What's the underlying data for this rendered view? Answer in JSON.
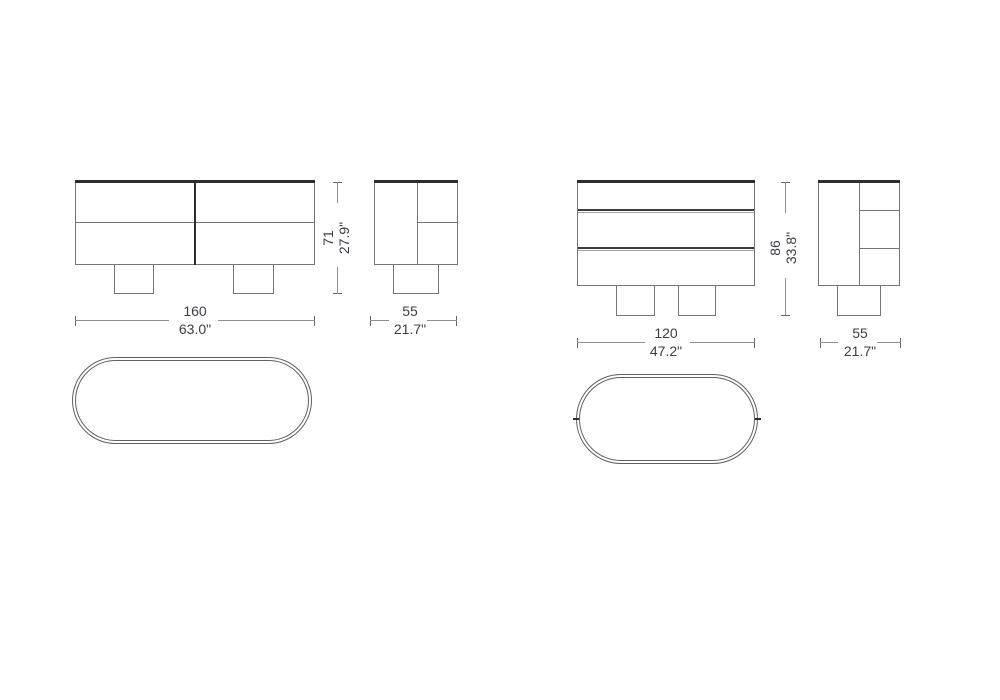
{
  "colors": {
    "line_gray": "#757575",
    "line_dark": "#2d2d2f",
    "oval_line": "#606060",
    "drawer_dark": "#3c3c3e",
    "drawer_gray": "#a5a5a5",
    "dim_line": "#8f8f8f",
    "dim_tick": "#666666",
    "text": "#3b3e42"
  },
  "drawings": {
    "left": {
      "front": {
        "width": {
          "cm": "160",
          "in": "63.0\""
        },
        "height": {
          "cm": "71",
          "in": "27.9\""
        }
      },
      "side": {
        "width": {
          "cm": "55",
          "in": "21.7\""
        }
      }
    },
    "right": {
      "front": {
        "width": {
          "cm": "120",
          "in": "47.2\""
        },
        "height": {
          "cm": "86",
          "in": "33.8\""
        }
      },
      "side": {
        "width": {
          "cm": "55",
          "in": "21.7\""
        }
      }
    }
  }
}
